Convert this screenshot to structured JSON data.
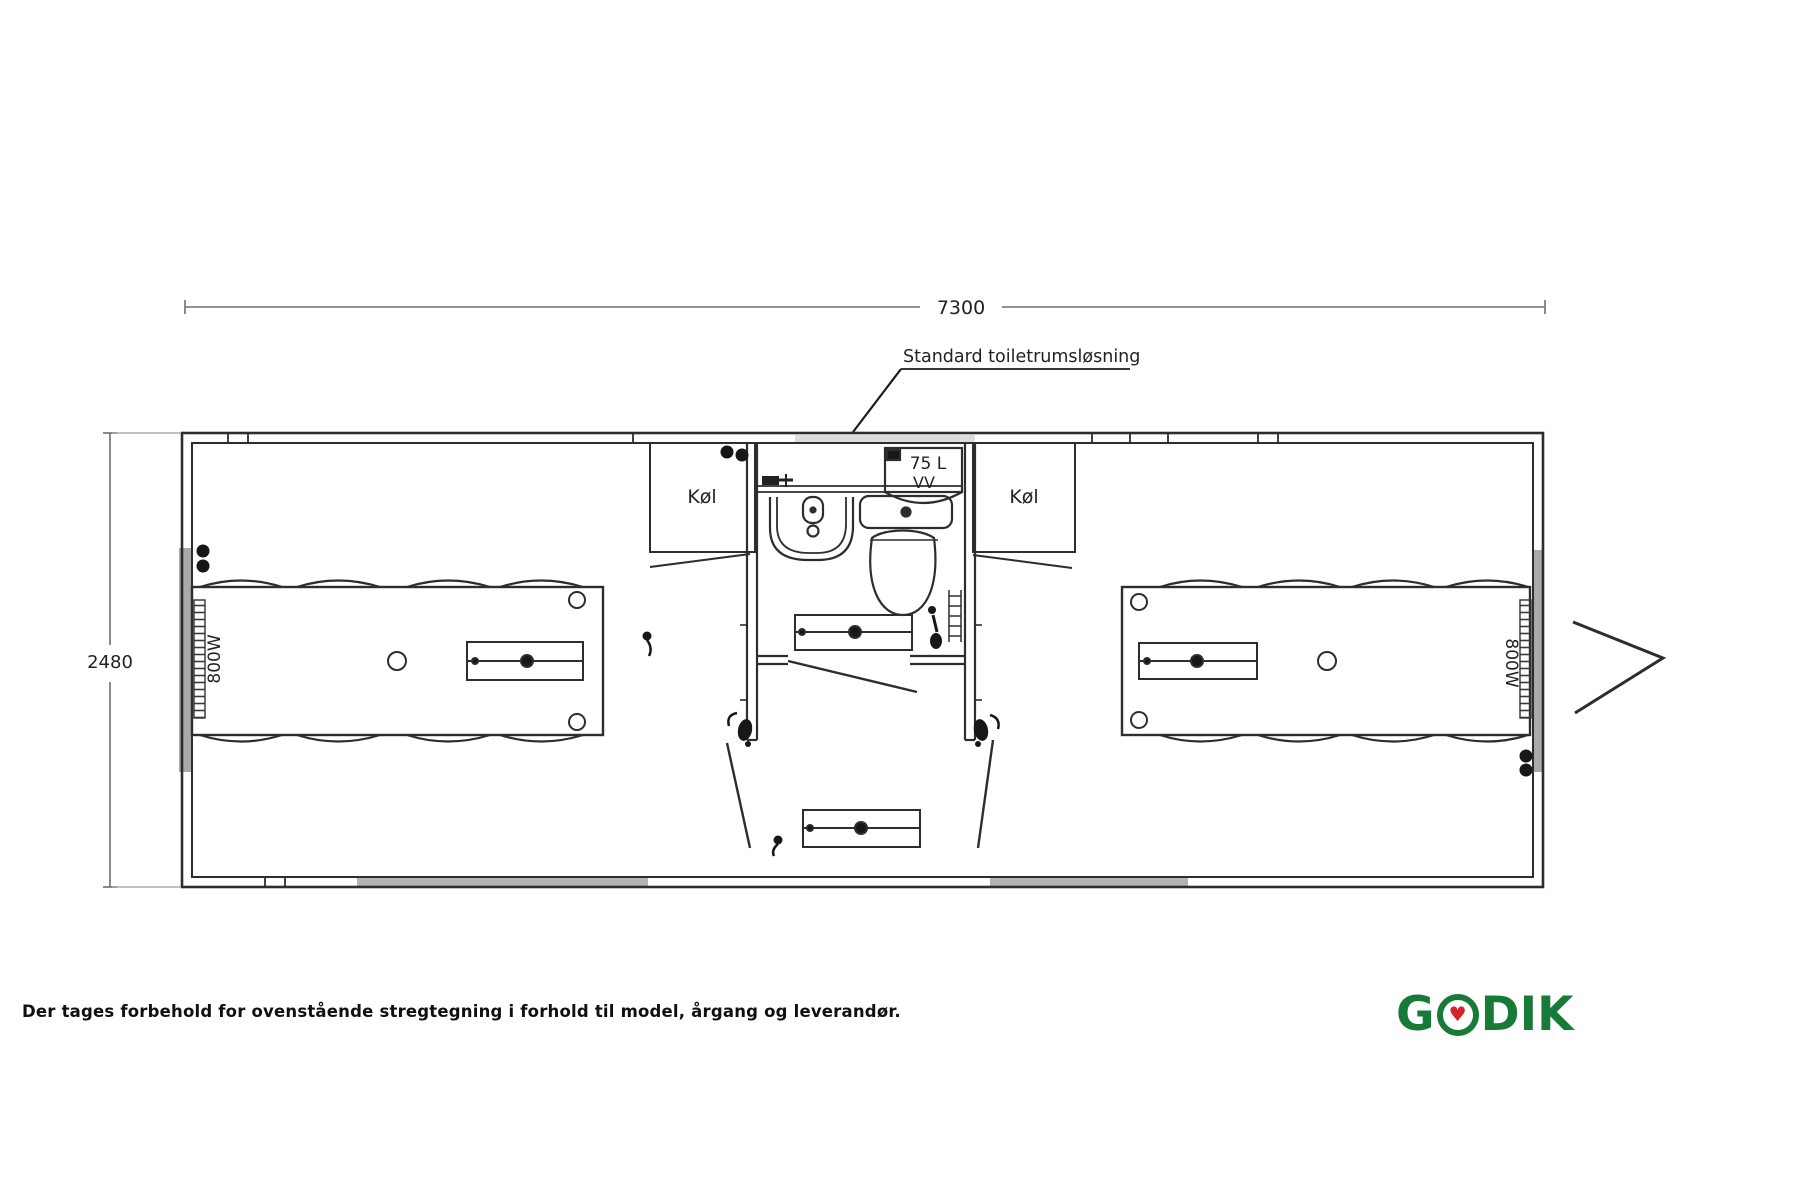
{
  "dimensions": {
    "length": "7300",
    "width": "2480"
  },
  "notes": {
    "toilet_room": "Standard toiletrumsløsning"
  },
  "rooms": {
    "fridge_left_label": "Køl",
    "fridge_right_label": "Køl",
    "boiler_line1": "75 L",
    "boiler_line2": "VV",
    "radiator_left_label": "800W",
    "radiator_right_label": "800W"
  },
  "footer": {
    "disclaimer": "Der tages forbehold for ovenstående stregtegning i forhold til model, årgang og leverandør."
  },
  "logo": {
    "prefix": "G",
    "suffix": "DIK",
    "heart": "♥",
    "green": "#187a38",
    "red": "#d8232a"
  }
}
